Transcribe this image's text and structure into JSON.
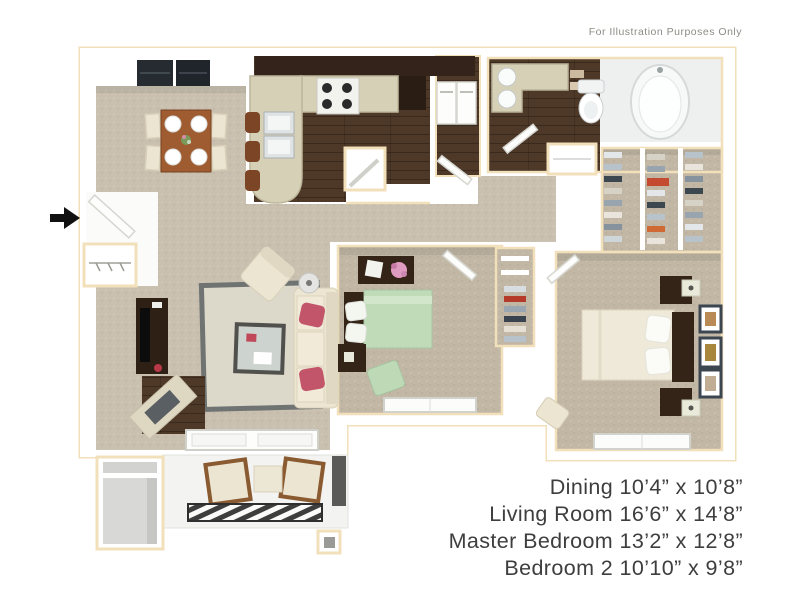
{
  "notice": {
    "text": "For Illustration Purposes Only",
    "color": "#8c8c86"
  },
  "room_dimensions": {
    "color": "#3e3e3e",
    "lines": [
      "Dining 10’4” x 10’8”",
      "Living Room 16’6” x 14’8”",
      "Master Bedroom 13’2” x 12’8”",
      "Bedroom 2 10’10” x 9’8”"
    ]
  },
  "floorplan": {
    "type": "apartment-floor-plan-3d-top-view",
    "rooms": [
      "dining",
      "kitchen",
      "laundry-closet",
      "pantry",
      "master-bathroom",
      "linen-closet",
      "walk-in-closet",
      "entry",
      "coat-closet",
      "living-room",
      "bedroom-2",
      "bedroom-2-closet",
      "master-bedroom",
      "patio",
      "storage-closet"
    ],
    "entry_marker": "black-arrow-pointing-right",
    "colors": {
      "wall_outline": "#f1e0ba",
      "carpet": "#c9c0b0",
      "carpet_bedroom": "#c2b7a5",
      "wood": "#4e3828",
      "wood_dark": "#33231a",
      "counter": "#d6d1b6",
      "upholstery": "#ece5d2",
      "furniture_dark": "#342417",
      "bed_green": "#c0dbb8",
      "accent_red": "#c2556a",
      "rug": "#dcd8ca",
      "rug_border": "#6f7372"
    }
  }
}
